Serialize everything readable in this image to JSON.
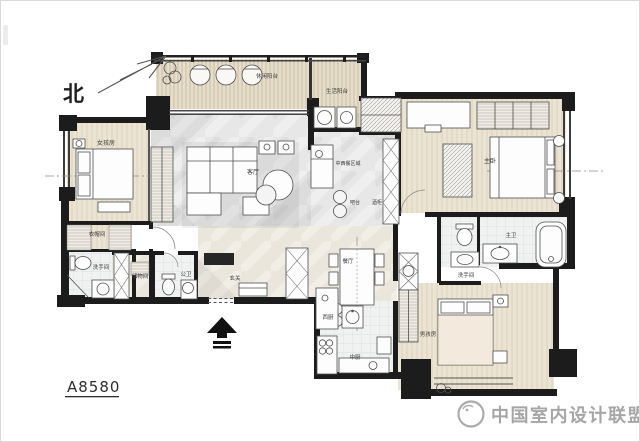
{
  "plan": {
    "drawing_number": "A8580",
    "north_label": "北"
  },
  "rooms": {
    "leisure_balcony": "休闲阳台",
    "utility_balcony": "生活阳台",
    "girls_room": "女孩房",
    "living_room": "客厅",
    "dining_zone_note": "中西餐区域",
    "bar_counter": "吧台",
    "wine_cabinet": "酒柜",
    "dining_room": "餐厅",
    "western_kitchen": "西厨",
    "chinese_kitchen": "中厨",
    "master_bedroom": "主卧",
    "master_bathroom": "主卫",
    "washroom_right": "洗手间",
    "boys_room": "男孩房",
    "cloakroom": "衣帽间",
    "washroom_left": "洗手间",
    "storage_room": "储物间",
    "guest_bathroom": "公卫",
    "foyer": "玄关"
  },
  "watermark": {
    "text": "中国室内设计联盟"
  },
  "palette": {
    "wall": "#1c1c1c",
    "wood_floor": "#ece4d3",
    "deck_floor": "#e6decb",
    "marble_floor": "#e7e7e7",
    "tile_floor": "#f0f1f1",
    "label_text": "#3a3a3a",
    "watermark_gray": "#a6a6a6"
  }
}
